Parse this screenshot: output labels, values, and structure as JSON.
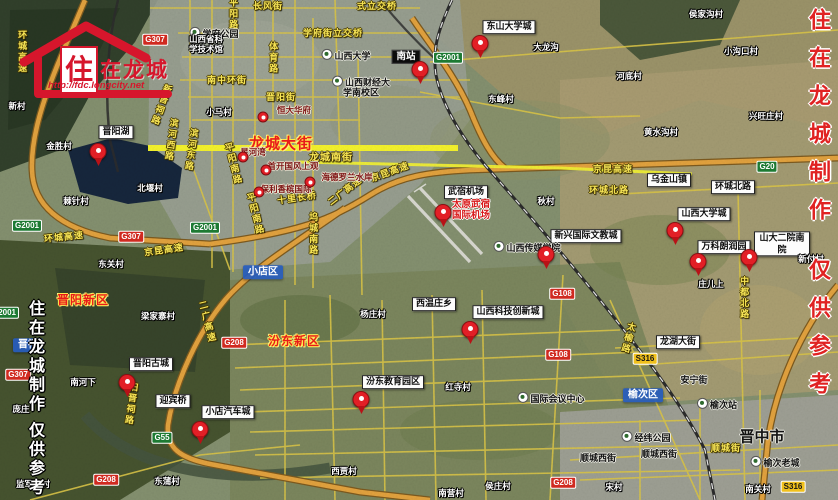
{
  "logo": {
    "zhu": "住",
    "rest": "在龙城",
    "url": "http://fdc.longcity.net"
  },
  "watermarks": {
    "left": "住在龙城制作 仅供参考",
    "right": "住在龙城制作 仅供参考"
  },
  "colors": {
    "brand_red": "#d6162c",
    "marker_red": "#e21f26",
    "highlight_road_yellow": "#f4f22c",
    "minor_road_yellow": "#d9c447",
    "highway_orange": "#e2a23e",
    "district_blue": "#265cbe",
    "watermark_right_red": "#e02222",
    "lake_dark": "#16263c"
  },
  "map": {
    "width": 838,
    "height": 500,
    "labels": [
      {
        "t": "环城高速",
        "k": "roadtext",
        "x": 22,
        "y": 52,
        "vert": true
      },
      {
        "t": "长风街",
        "k": "roadtext",
        "x": 268,
        "y": 6
      },
      {
        "t": "平阳路",
        "k": "roadtext",
        "x": 233,
        "y": 14,
        "vert": true
      },
      {
        "t": "式立交桥",
        "k": "roadtext",
        "x": 377,
        "y": 6
      },
      {
        "t": "学府街立交桥",
        "k": "roadtext",
        "x": 333,
        "y": 33
      },
      {
        "t": "体育路",
        "k": "roadtext",
        "x": 273,
        "y": 58,
        "vert": true
      },
      {
        "t": "南中环街",
        "k": "roadtext",
        "x": 227,
        "y": 80
      },
      {
        "t": "晋阳街",
        "k": "roadtext",
        "x": 281,
        "y": 97
      },
      {
        "t": "新晋祠路",
        "k": "roadtext",
        "x": 161,
        "y": 105,
        "vert": true,
        "r": 20
      },
      {
        "t": "滨河西路",
        "k": "roadtext",
        "x": 171,
        "y": 140,
        "vert": true,
        "r": 8
      },
      {
        "t": "滨河东路",
        "k": "roadtext",
        "x": 191,
        "y": 150,
        "vert": true,
        "r": 8
      },
      {
        "t": "环城高速",
        "k": "roadtext",
        "x": 64,
        "y": 237,
        "r": -6
      },
      {
        "t": "京昆高速",
        "k": "roadtext",
        "x": 164,
        "y": 250,
        "r": -8
      },
      {
        "t": "十里长桥",
        "k": "roadtext",
        "x": 297,
        "y": 198,
        "r": -8
      },
      {
        "t": "二广高速",
        "k": "roadtext",
        "x": 345,
        "y": 191,
        "r": -38
      },
      {
        "t": "京昆高速",
        "k": "roadtext",
        "x": 390,
        "y": 172,
        "r": -20
      },
      {
        "t": "京昆高速",
        "k": "roadtext",
        "x": 613,
        "y": 169
      },
      {
        "t": "环城北路",
        "k": "roadtext",
        "x": 609,
        "y": 190
      },
      {
        "t": "坞城南路",
        "k": "roadtext",
        "x": 313,
        "y": 234,
        "vert": true
      },
      {
        "t": "平阳南路",
        "k": "roadtext",
        "x": 233,
        "y": 164,
        "vert": true,
        "r": -14
      },
      {
        "t": "平阳南路",
        "k": "roadtext",
        "x": 255,
        "y": 214,
        "vert": true,
        "r": -14
      },
      {
        "t": "龙城南街",
        "k": "roadtext",
        "x": 331,
        "y": 158,
        "s": 10
      },
      {
        "t": "二广高速",
        "k": "roadtext",
        "x": 207,
        "y": 322,
        "vert": true,
        "r": -14
      },
      {
        "t": "旧晋祠路",
        "k": "roadtext",
        "x": 131,
        "y": 404,
        "vert": true,
        "r": 8
      },
      {
        "t": "中都北路",
        "k": "roadtext",
        "x": 744,
        "y": 298,
        "vert": true
      },
      {
        "t": "太榆路",
        "k": "roadtext",
        "x": 628,
        "y": 338,
        "vert": true,
        "r": 14
      },
      {
        "t": "顺城街",
        "k": "roadtext",
        "x": 726,
        "y": 448
      },
      {
        "t": "龙城大街",
        "k": "redyellow",
        "x": 281,
        "y": 144,
        "s": 15,
        "n": "longcheng-avenue-label"
      },
      {
        "t": "晋阳新区",
        "k": "redyellow",
        "x": 83,
        "y": 301,
        "n": "jinyang-newdistrict-label"
      },
      {
        "t": "汾东新区",
        "k": "redyellow",
        "x": 294,
        "y": 342,
        "n": "fendong-newdistrict-label"
      },
      {
        "t": "晋阳湖",
        "k": "whitebox",
        "x": 116,
        "y": 132,
        "n": "jinyang-lake-label"
      },
      {
        "t": "东山大学城",
        "k": "whitebox",
        "x": 509,
        "y": 27
      },
      {
        "t": "武宿机场",
        "k": "whitebox",
        "x": 466,
        "y": 192
      },
      {
        "t": "新兴国际文教城",
        "k": "whitebox",
        "x": 586,
        "y": 236
      },
      {
        "t": "山西大学城",
        "k": "whitebox",
        "x": 704,
        "y": 214
      },
      {
        "t": "万科朗润园",
        "k": "whitebox",
        "x": 724,
        "y": 247
      },
      {
        "t": "山大二院南院",
        "k": "whitebox",
        "x": 782,
        "y": 244
      },
      {
        "t": "乌金山镇",
        "k": "whitebox",
        "x": 669,
        "y": 180
      },
      {
        "t": "环城北路",
        "k": "whitebox",
        "x": 733,
        "y": 187
      },
      {
        "t": "山西科技创新城",
        "k": "whitebox",
        "x": 508,
        "y": 312
      },
      {
        "t": "龙湖大街",
        "k": "whitebox",
        "x": 678,
        "y": 342
      },
      {
        "t": "西温庄乡",
        "k": "whitebox",
        "x": 434,
        "y": 304
      },
      {
        "t": "汾东教育园区",
        "k": "whitebox",
        "x": 393,
        "y": 382
      },
      {
        "t": "晋阳古城",
        "k": "whitebox",
        "x": 151,
        "y": 364
      },
      {
        "t": "迎宾桥",
        "k": "whitebox",
        "x": 173,
        "y": 401
      },
      {
        "t": "小店汽车城",
        "k": "whitebox",
        "x": 228,
        "y": 412
      },
      {
        "t": "南站",
        "k": "blackbox",
        "x": 406,
        "y": 57,
        "n": "south-station-label"
      },
      {
        "t": "小店区",
        "k": "bluebox",
        "x": 263,
        "y": 272,
        "n": "xiaodian-district-label"
      },
      {
        "t": "榆次区",
        "k": "bluebox",
        "x": 643,
        "y": 395,
        "n": "yuci-district-label"
      },
      {
        "t": "晋祠",
        "k": "bluebox",
        "x": 28,
        "y": 345
      },
      {
        "t": "太原武宿\n国际机场",
        "k": "redtext",
        "x": 471,
        "y": 211,
        "n": "wusu-airport-label"
      },
      {
        "t": "星河湾",
        "k": "project",
        "x": 253,
        "y": 153
      },
      {
        "t": "首开国风上观",
        "k": "project",
        "x": 293,
        "y": 167
      },
      {
        "t": "保利香槟国际",
        "k": "project",
        "x": 286,
        "y": 190
      },
      {
        "t": "海德罗兰水岸",
        "k": "project",
        "x": 347,
        "y": 178
      },
      {
        "t": "恒大华府",
        "k": "project",
        "x": 294,
        "y": 111
      },
      {
        "t": "学府公园",
        "k": "placedark",
        "x": 214,
        "y": 33,
        "icon": true
      },
      {
        "t": "山西大学",
        "k": "placedark",
        "x": 346,
        "y": 55,
        "icon": true
      },
      {
        "t": "山西财经大\n学南校区",
        "k": "placedark",
        "x": 361,
        "y": 87,
        "icon": true
      },
      {
        "t": "山西传媒学院",
        "k": "placedark",
        "x": 527,
        "y": 247,
        "icon": true
      },
      {
        "t": "国际会议中心",
        "k": "placedark",
        "x": 551,
        "y": 398,
        "icon": true
      },
      {
        "t": "经纬公园",
        "k": "placedark",
        "x": 646,
        "y": 437,
        "icon": true
      },
      {
        "t": "榆次站",
        "k": "placedark",
        "x": 717,
        "y": 404,
        "icon": true
      },
      {
        "t": "榆次老城",
        "k": "placedark",
        "x": 775,
        "y": 462,
        "icon": true
      },
      {
        "t": "顺城西街",
        "k": "placedark",
        "x": 598,
        "y": 458
      },
      {
        "t": "顺城西街",
        "k": "placedark",
        "x": 659,
        "y": 454
      },
      {
        "t": "安宁街",
        "k": "placedark",
        "x": 694,
        "y": 380
      },
      {
        "t": "晋中市",
        "k": "placedark",
        "x": 762,
        "y": 437,
        "s": 15,
        "n": "jinzhong-city-label"
      },
      {
        "t": "山西省科\n学技术馆",
        "k": "village",
        "x": 206,
        "y": 45
      },
      {
        "t": "新村",
        "k": "village",
        "x": 17,
        "y": 107
      },
      {
        "t": "金胜村",
        "k": "village",
        "x": 59,
        "y": 147
      },
      {
        "t": "棘针村",
        "k": "village",
        "x": 76,
        "y": 202
      },
      {
        "t": "北堰村",
        "k": "village",
        "x": 150,
        "y": 189
      },
      {
        "t": "东关村",
        "k": "village",
        "x": 111,
        "y": 265
      },
      {
        "t": "小马村",
        "k": "village",
        "x": 219,
        "y": 113
      },
      {
        "t": "大龙沟",
        "k": "village",
        "x": 546,
        "y": 48
      },
      {
        "t": "东峰村",
        "k": "village",
        "x": 501,
        "y": 100
      },
      {
        "t": "河底村",
        "k": "village",
        "x": 629,
        "y": 77
      },
      {
        "t": "侯家沟村",
        "k": "village",
        "x": 706,
        "y": 15
      },
      {
        "t": "小沟口村",
        "k": "village",
        "x": 741,
        "y": 52
      },
      {
        "t": "兴旺庄村",
        "k": "village",
        "x": 766,
        "y": 117
      },
      {
        "t": "黄水沟村",
        "k": "village",
        "x": 661,
        "y": 133
      },
      {
        "t": "秋村",
        "k": "village",
        "x": 546,
        "y": 202
      },
      {
        "t": "梁家寨村",
        "k": "village",
        "x": 158,
        "y": 317
      },
      {
        "t": "南河下",
        "k": "village",
        "x": 83,
        "y": 383
      },
      {
        "t": "庞庄",
        "k": "village",
        "x": 21,
        "y": 410
      },
      {
        "t": "监军庄村",
        "k": "village",
        "x": 33,
        "y": 485
      },
      {
        "t": "东蒲村",
        "k": "village",
        "x": 167,
        "y": 482
      },
      {
        "t": "西贾村",
        "k": "village",
        "x": 344,
        "y": 472
      },
      {
        "t": "南营村",
        "k": "village",
        "x": 451,
        "y": 494
      },
      {
        "t": "侯庄村",
        "k": "village",
        "x": 498,
        "y": 487
      },
      {
        "t": "杨庄村",
        "k": "village",
        "x": 373,
        "y": 315
      },
      {
        "t": "红寺村",
        "k": "village",
        "x": 458,
        "y": 388
      },
      {
        "t": "庄儿上",
        "k": "village",
        "x": 711,
        "y": 285
      },
      {
        "t": "新付村",
        "k": "village",
        "x": 811,
        "y": 260
      },
      {
        "t": "宋村",
        "k": "village",
        "x": 614,
        "y": 488
      },
      {
        "t": "南关村",
        "k": "village",
        "x": 758,
        "y": 490
      },
      {
        "t": "G307",
        "k": "badge-g",
        "x": 155,
        "y": 40
      },
      {
        "t": "G2001",
        "k": "badge-gx",
        "x": 448,
        "y": 58
      },
      {
        "t": "G2001",
        "k": "badge-gx",
        "x": 27,
        "y": 226
      },
      {
        "t": "G307",
        "k": "badge-g",
        "x": 131,
        "y": 237
      },
      {
        "t": "G2001",
        "k": "badge-gx",
        "x": 205,
        "y": 228
      },
      {
        "t": "G2001",
        "k": "badge-gx",
        "x": 4,
        "y": 313
      },
      {
        "t": "G20",
        "k": "badge-gx",
        "x": 767,
        "y": 167
      },
      {
        "t": "S316",
        "k": "badge-s",
        "x": 645,
        "y": 359
      },
      {
        "t": "G108",
        "k": "badge-g",
        "x": 562,
        "y": 294
      },
      {
        "t": "G108",
        "k": "badge-g",
        "x": 558,
        "y": 355
      },
      {
        "t": "G208",
        "k": "badge-g",
        "x": 234,
        "y": 343
      },
      {
        "t": "G55",
        "k": "badge-gx",
        "x": 162,
        "y": 438
      },
      {
        "t": "G208",
        "k": "badge-g",
        "x": 106,
        "y": 480
      },
      {
        "t": "G208",
        "k": "badge-g",
        "x": 563,
        "y": 483
      },
      {
        "t": "S316",
        "k": "badge-s",
        "x": 793,
        "y": 487
      },
      {
        "t": "G307",
        "k": "badge-g",
        "x": 18,
        "y": 375
      }
    ],
    "markers": [
      {
        "k": "pin",
        "x": 98,
        "y": 160,
        "n": "marker-jinyang-lake"
      },
      {
        "k": "pin",
        "x": 420,
        "y": 78,
        "n": "marker-south-station"
      },
      {
        "k": "pin",
        "x": 480,
        "y": 52,
        "n": "marker-dongshan-univ-town"
      },
      {
        "k": "pin",
        "x": 443,
        "y": 221,
        "n": "marker-wusu-airport"
      },
      {
        "k": "pin",
        "x": 546,
        "y": 263,
        "n": "marker-wenjiao-city"
      },
      {
        "k": "pin",
        "x": 675,
        "y": 239,
        "n": "marker-shanxi-univ-town"
      },
      {
        "k": "pin",
        "x": 698,
        "y": 270,
        "n": "marker-vanke-langrun"
      },
      {
        "k": "pin",
        "x": 749,
        "y": 266,
        "n": "marker-shanda-hospital"
      },
      {
        "k": "pin",
        "x": 470,
        "y": 338,
        "n": "marker-scitech-city"
      },
      {
        "k": "pin",
        "x": 361,
        "y": 408,
        "n": "marker-fendong-edu"
      },
      {
        "k": "pin",
        "x": 127,
        "y": 391,
        "n": "marker-jinyang-gucheng"
      },
      {
        "k": "pin",
        "x": 200,
        "y": 438,
        "n": "marker-auto-city"
      },
      {
        "k": "dot",
        "x": 263,
        "y": 117,
        "n": "marker-hengda"
      },
      {
        "k": "dot",
        "x": 243,
        "y": 157,
        "n": "marker-xinghewan"
      },
      {
        "k": "dot",
        "x": 266,
        "y": 170,
        "n": "marker-shoukai"
      },
      {
        "k": "dot",
        "x": 259,
        "y": 192,
        "n": "marker-baoli"
      },
      {
        "k": "dot",
        "x": 310,
        "y": 182,
        "n": "marker-haide"
      }
    ]
  }
}
